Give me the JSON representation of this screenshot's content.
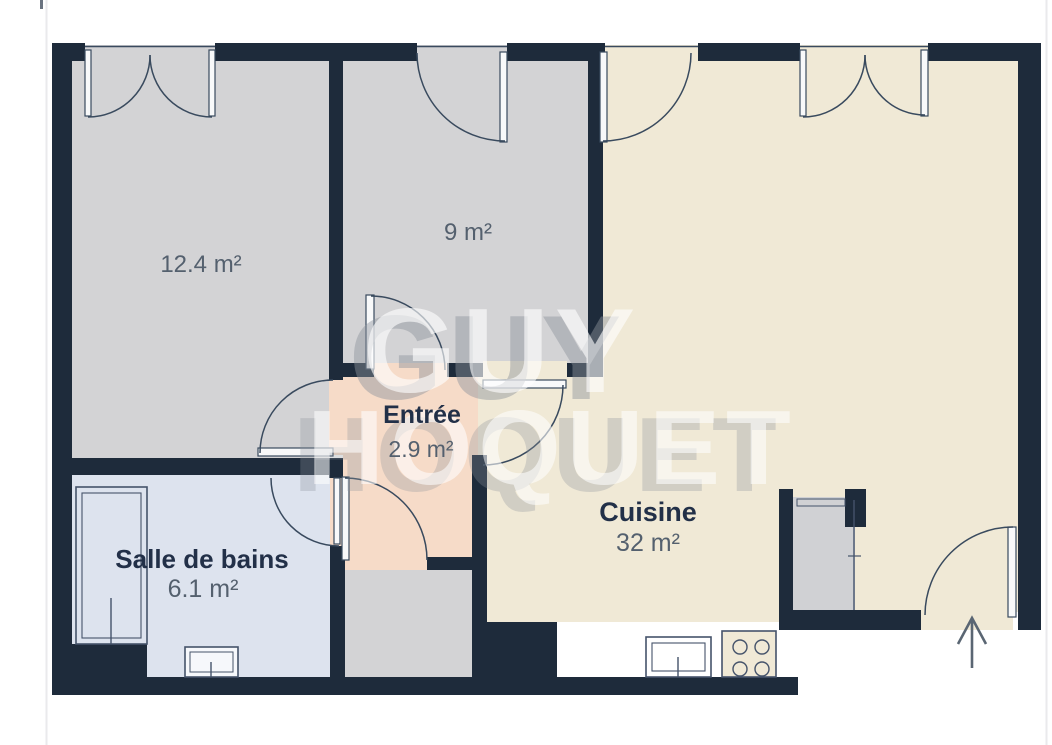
{
  "plan": {
    "type": "apartment-floor-plan",
    "watermark": {
      "line1": "GUY",
      "line2": "HOQUET"
    },
    "rooms": [
      {
        "id": "bedroom-1",
        "name": "",
        "area": "12.4 m²"
      },
      {
        "id": "bedroom-2",
        "name": "",
        "area": "9 m²"
      },
      {
        "id": "entree",
        "name": "Entrée",
        "area": "2.9 m²"
      },
      {
        "id": "cuisine",
        "name": "Cuisine",
        "area": "32 m²"
      },
      {
        "id": "salle-de-bains",
        "name": "Salle de bains",
        "area": "6.1 m²"
      }
    ],
    "fixtures": [
      "bathtub",
      "bathroom-sink",
      "kitchen-sink",
      "cooktop",
      "closet"
    ],
    "icons": {
      "entrance_arrow": "up-arrow"
    },
    "colors": {
      "wall": "#1e2b3b",
      "room_gray": "#d3d3d5",
      "kitchen_cream": "#f0e9d6",
      "entry_peach": "#f6dbc8",
      "bath_blue": "#dde3ee",
      "closet_gray": "#d0d1d4",
      "line": "#394a5e",
      "label": "#223048",
      "area_text": "#54606e",
      "watermark": "#ffffff"
    }
  }
}
